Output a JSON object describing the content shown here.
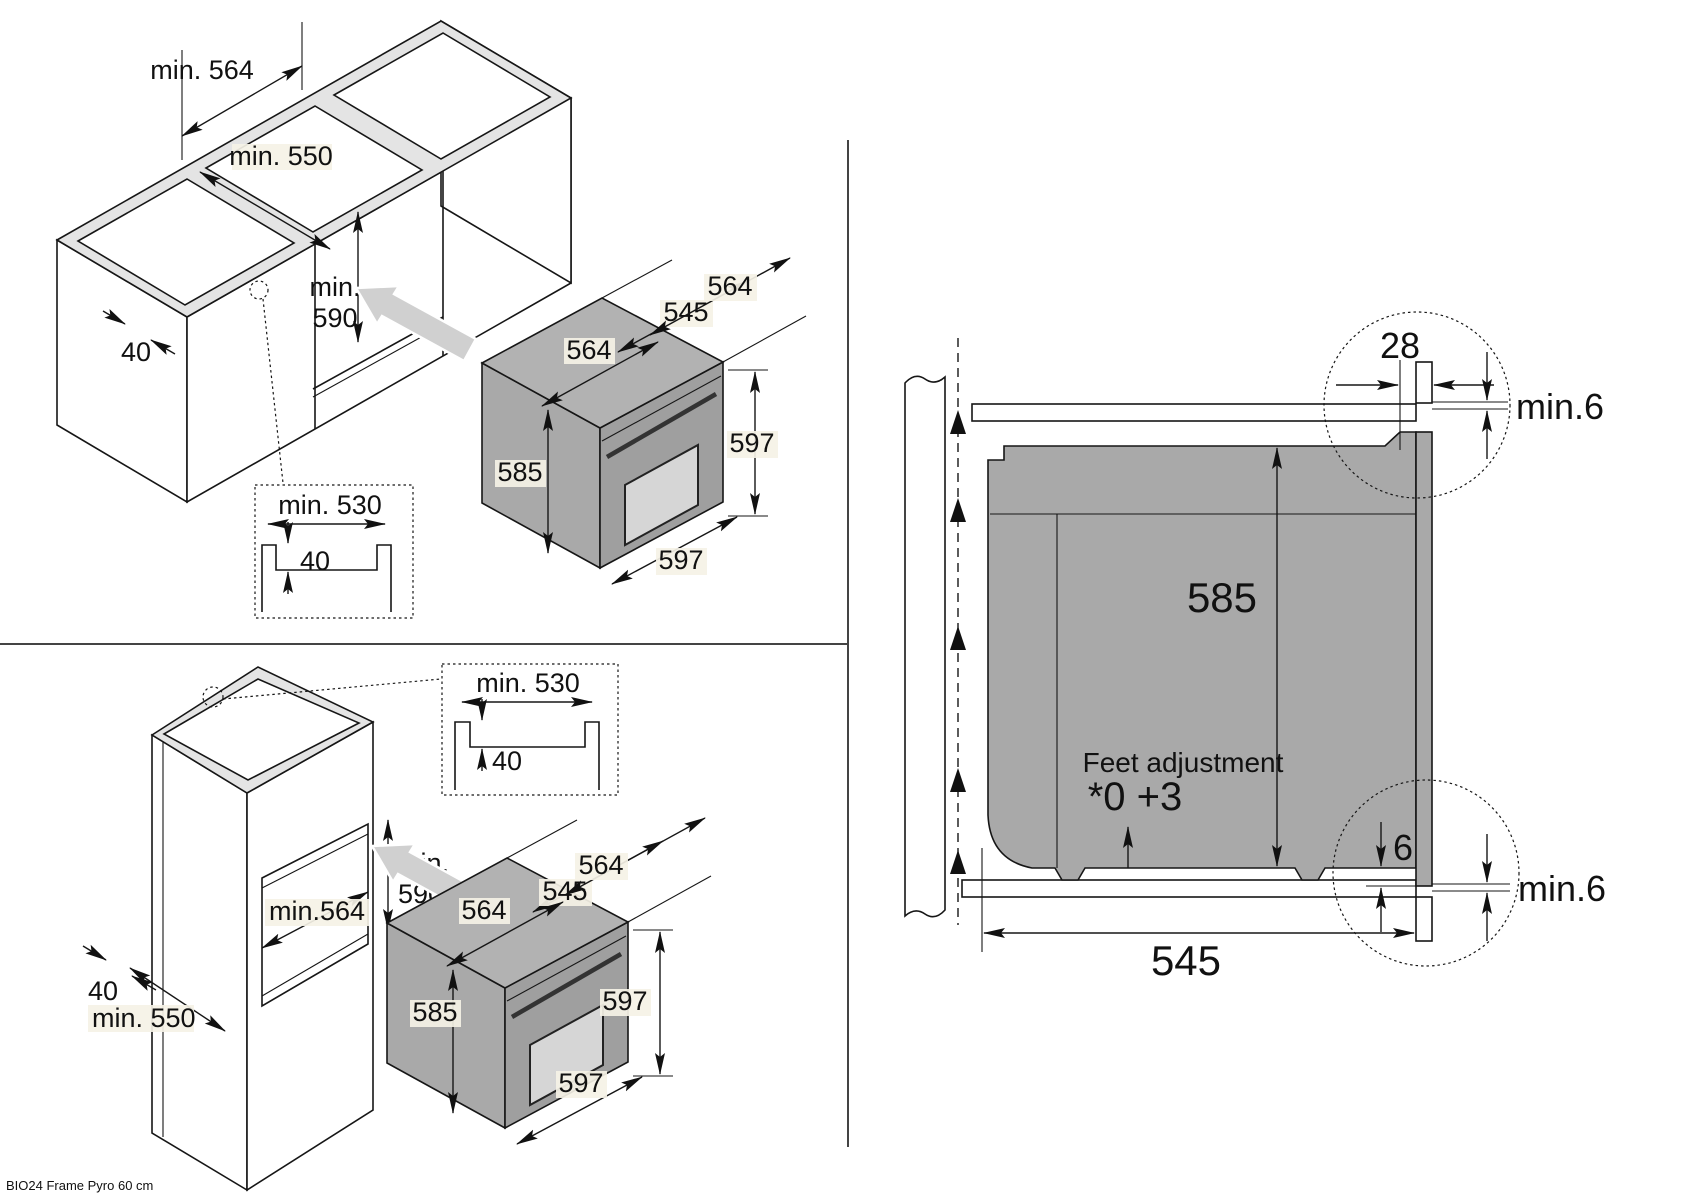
{
  "footer": {
    "model": "BIO24 Frame Pyro 60 cm"
  },
  "colors": {
    "line": "#161616",
    "oven_gray": "#a9a9a9",
    "label_bg": "#f5f2e6",
    "arrow_gray": "#d0d0d0"
  },
  "under_counter": {
    "niche_width": "min. 564",
    "niche_depth": "min. 550",
    "niche_h1": "min.",
    "niche_h2": "590",
    "rail": "40",
    "groove_width": "min. 530",
    "groove_depth": "40",
    "oven": {
      "depth_top": "564",
      "depth_body": "545",
      "width_top": "564",
      "height_body": "585",
      "height_front": "597",
      "width_front": "597"
    }
  },
  "tall_cabinet": {
    "niche_width": "min.564",
    "niche_h1": "min.",
    "niche_h2": "590",
    "rail": "40",
    "niche_depth": "min. 550",
    "groove_width": "min. 530",
    "groove_depth": "40",
    "oven": {
      "depth_top": "564",
      "depth_body": "545",
      "width_top": "564",
      "height_body": "585",
      "height_front": "597",
      "width_front": "597"
    }
  },
  "section": {
    "frame_overlap": "28",
    "top_clearance": "min.6",
    "height": "585",
    "feet_note": "Feet adjustment",
    "feet_values": "*0 +3",
    "bottom_gap": "6",
    "bottom_clearance": "min.6",
    "depth": "545"
  }
}
